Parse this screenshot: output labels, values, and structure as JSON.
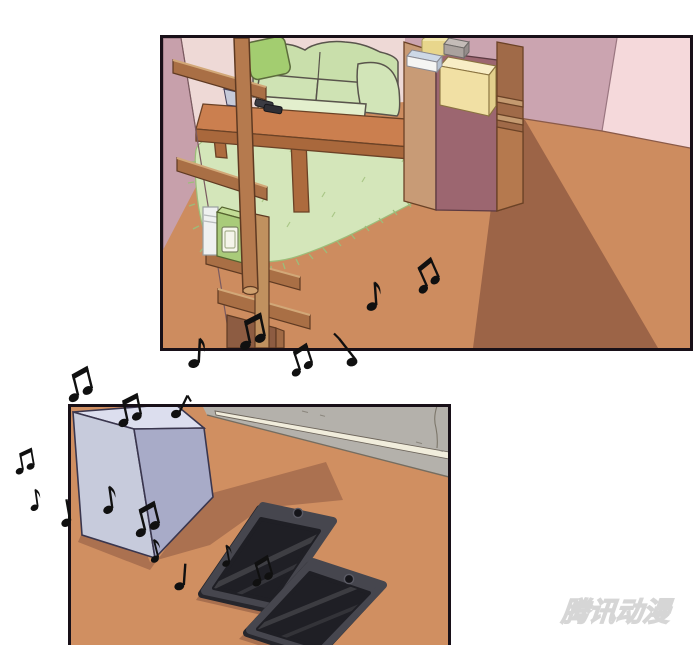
{
  "page": {
    "width": 700,
    "height": 645,
    "background": "#ffffff",
    "type": "comic-strip"
  },
  "watermark": {
    "text": "腾讯动漫",
    "color": "#d6d6d6"
  },
  "panels": {
    "living_room": {
      "objects": [
        "sofa",
        "throw-pillow",
        "coffee-table",
        "mini-speaker-on-table",
        "phones-on-table",
        "area-rug",
        "bookshelf",
        "books",
        "wood-pole",
        "storage-cabinet",
        "boxes-on-cabinet",
        "floor-shadow"
      ],
      "wall_colors": [
        "#eed9d6",
        "#c7a0ab",
        "#cba4b0",
        "#f5d9db"
      ],
      "floor_color": "#cd8c5f"
    },
    "floor_closeup": {
      "objects": [
        "speaker-box",
        "phone-1",
        "phone-2",
        "baseboard-wall",
        "speaker-shadow"
      ],
      "floor_color": "#d08f61",
      "speaker_colors": [
        "#dcdeee",
        "#c7cbdc",
        "#a8abc8"
      ],
      "phone_body_color": "#46464e",
      "phone_screen_color": "#1f1f25",
      "baseboard_colors": [
        "#b4b1ab",
        "#f1eddc"
      ]
    }
  },
  "music_notes": {
    "count": 18,
    "color": "#101010"
  }
}
